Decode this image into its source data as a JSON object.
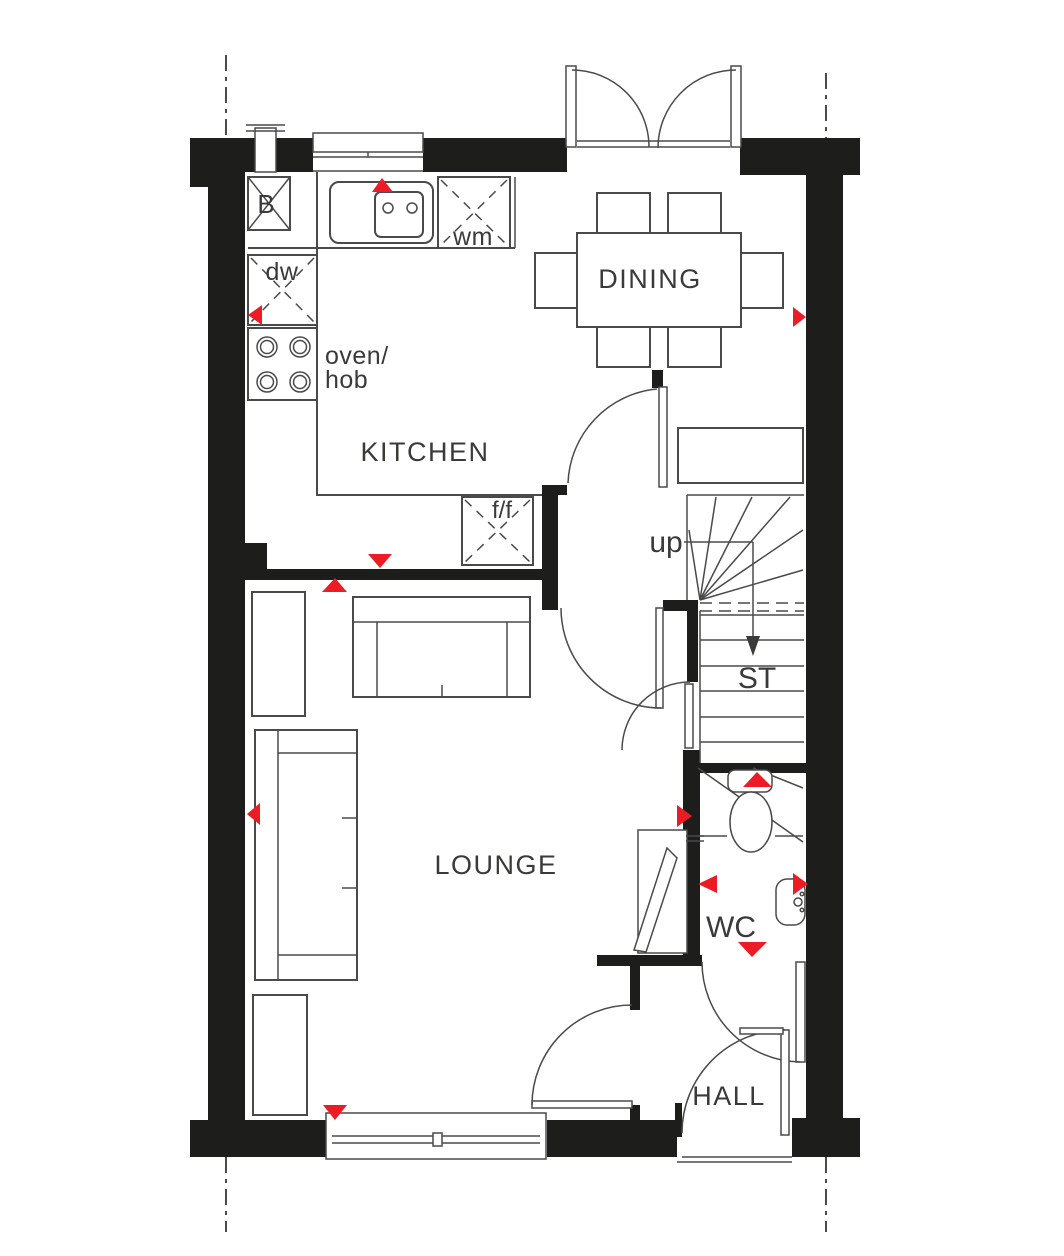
{
  "colors": {
    "wall": "#1d1d1b",
    "line": "#4a4a4a",
    "red": "#ec1b24",
    "bg": "#ffffff"
  },
  "labels": {
    "kitchen": "KITCHEN",
    "dining": "DINING",
    "lounge": "LOUNGE",
    "hall": "HALL",
    "wc": "WC",
    "store": "ST",
    "up": "up",
    "boiler": "B",
    "dishwasher": "dw",
    "washing_machine": "wm",
    "oven_hob_line1": "oven/",
    "oven_hob_line2": "hob",
    "fridge_freezer": "f/f"
  }
}
